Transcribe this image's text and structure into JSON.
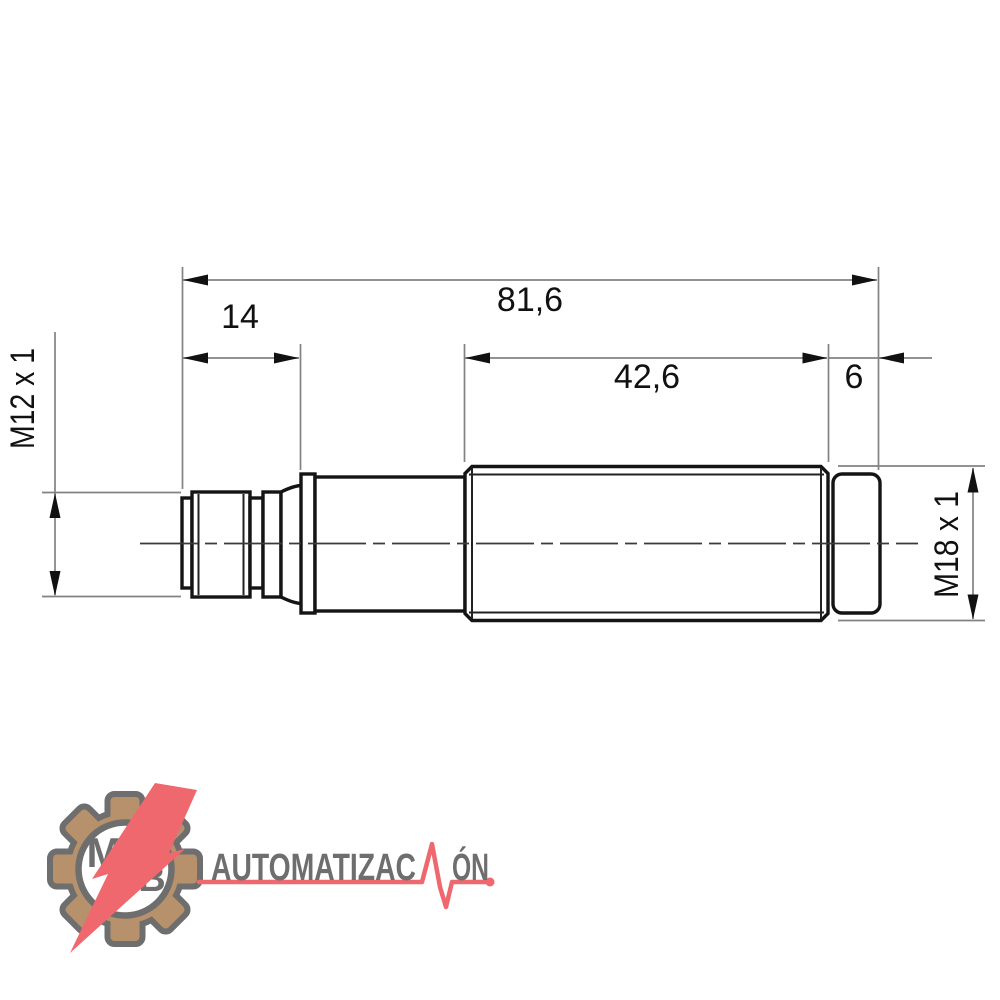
{
  "drawing": {
    "type": "technical-dimension-drawing",
    "dim_total_length": "81,6",
    "dim_connector_length": "14",
    "dim_body_length": "42,6",
    "dim_cap_length": "6",
    "label_connector_thread": "M12 x 1",
    "label_body_thread": "M18 x 1",
    "colors": {
      "outline": "#141414",
      "dim_line": "#828282",
      "arrow": "#111111",
      "text": "#111111"
    }
  },
  "logo": {
    "monogram_top": "M",
    "monogram_bottom": "B",
    "brand_text_before_pulse": "AUTOMATIZAC",
    "brand_text_after_pulse": "ÓN",
    "brand_full": "AUTOMATIZACIÓN",
    "colors": {
      "gear_fill": "#b6916b",
      "gear_outline": "#6e6e6e",
      "accent_red": "#ee686e",
      "text_gray": "#6e6e6e"
    }
  }
}
